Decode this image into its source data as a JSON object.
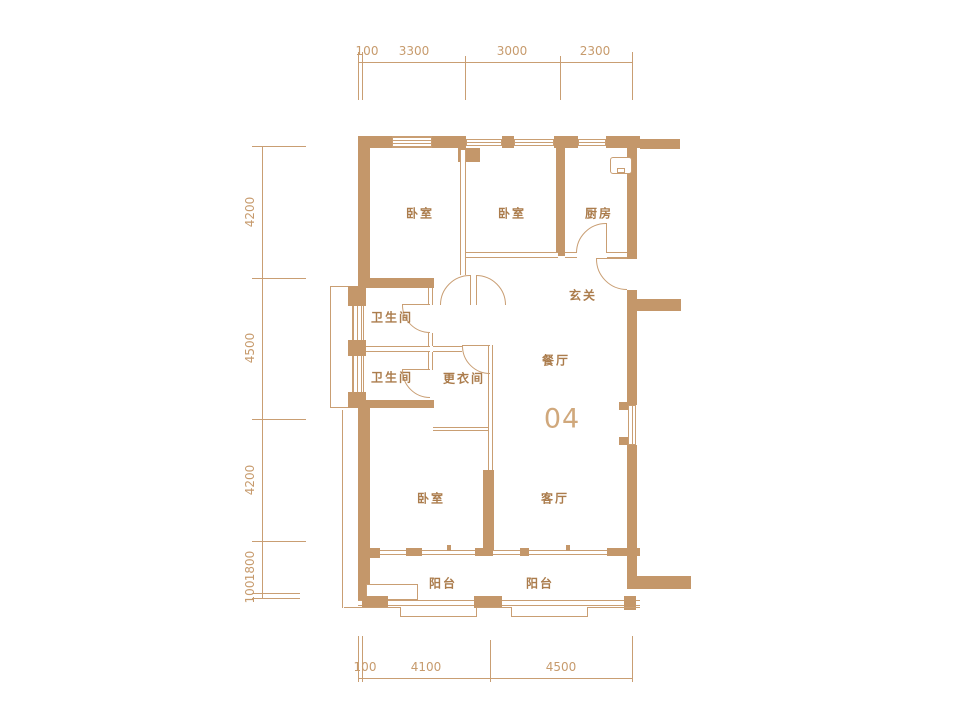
{
  "unit": {
    "number": "04"
  },
  "rooms": {
    "bedroom1": "卧室",
    "bedroom2": "卧室",
    "bedroom3": "卧室",
    "kitchen": "厨房",
    "entry": "玄关",
    "bath1": "卫生间",
    "bath2": "卫生间",
    "dressing": "更衣间",
    "dining": "餐厅",
    "living": "客厅",
    "balcony1": "阳台",
    "balcony2": "阳台"
  },
  "dimensions": {
    "top": [
      "100",
      "3300",
      "3000",
      "2300"
    ],
    "left": [
      "4200",
      "4500",
      "4200",
      "1800",
      "100"
    ],
    "bottom": [
      "100",
      "4100",
      "4500"
    ]
  },
  "colors": {
    "wall": "#c4976a",
    "line": "#c99e73",
    "label": "#ab7c4c",
    "dim": "#c79b6d",
    "unit": "#d0a87c"
  }
}
